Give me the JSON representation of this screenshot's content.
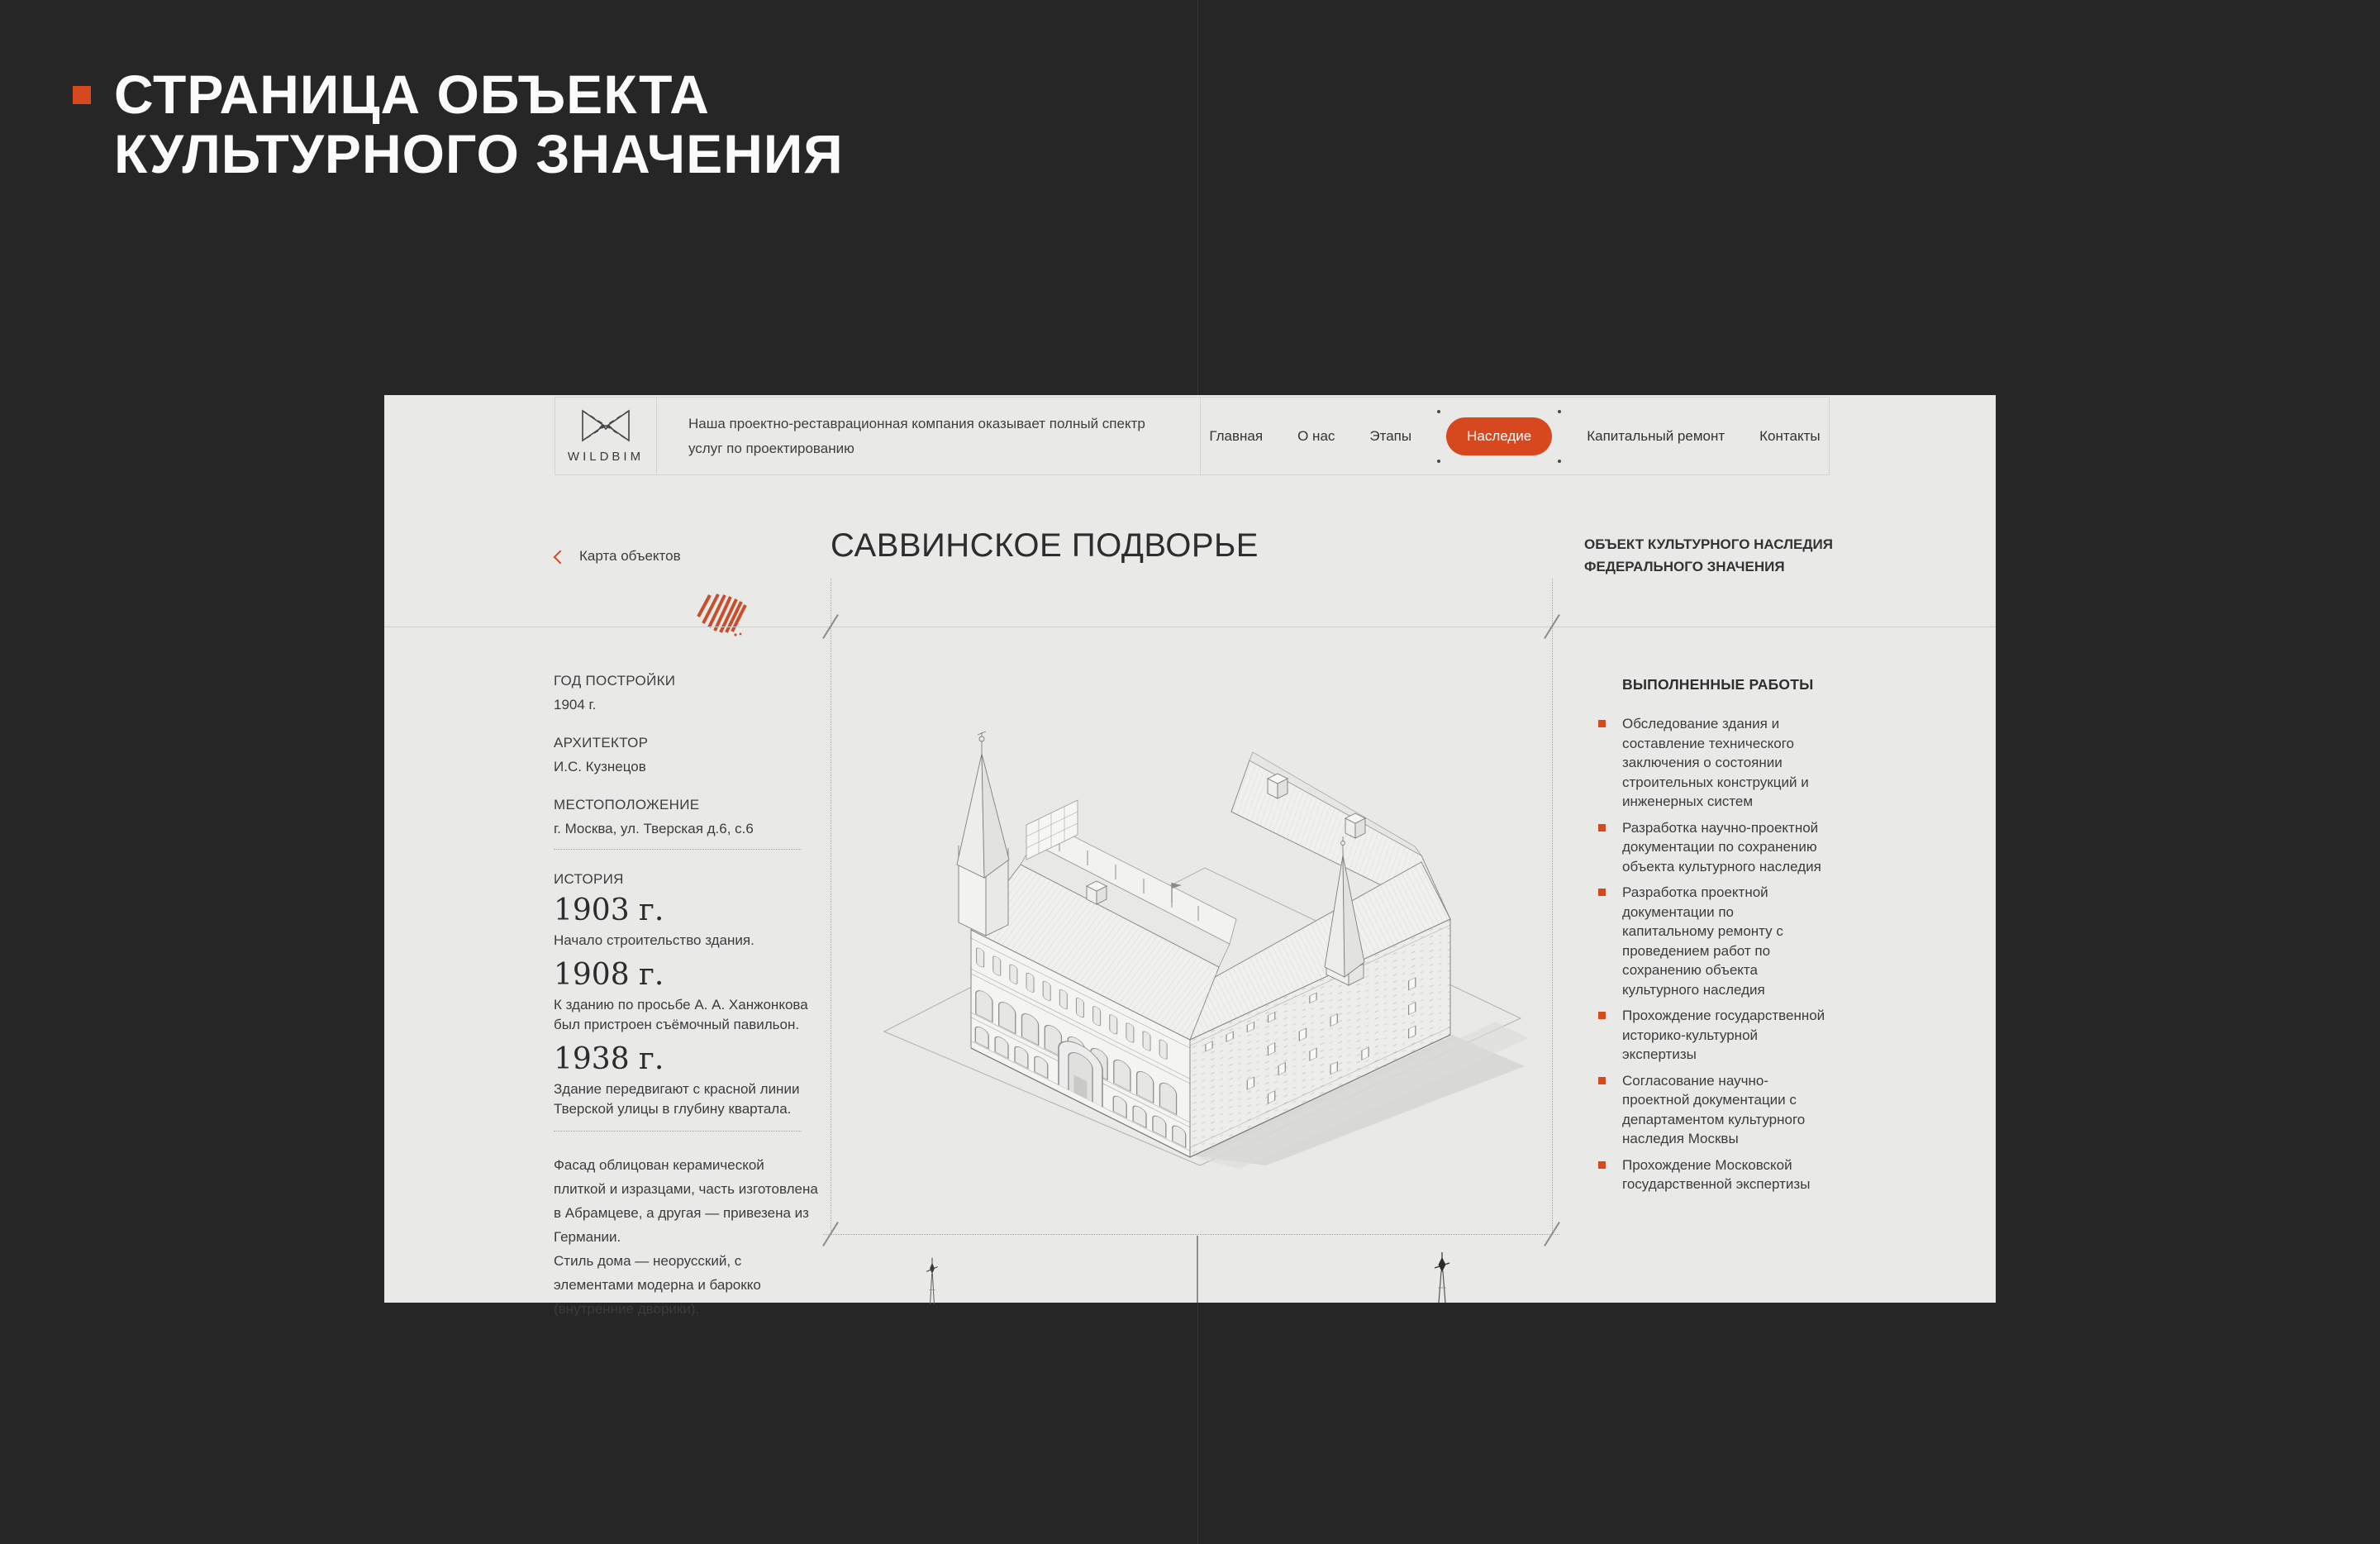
{
  "colors": {
    "accent": "#d8481e",
    "dark_bg": "#262627",
    "page_bg": "#e9e9e8"
  },
  "slide": {
    "title": "СТРАНИЦА ОБЪЕКТА\nКУЛЬТУРНОГО ЗНАЧЕНИЯ"
  },
  "header": {
    "logo": "WILDBIM",
    "tagline": "Наша проектно-реставрационная компания оказывает полный спектр\nуслуг по проектированию",
    "nav": [
      "Главная",
      "О нас",
      "Этапы",
      "Наследие",
      "Капитальный ремонт",
      "Контакты"
    ],
    "active_nav": "Наследие"
  },
  "page": {
    "back_link": "Карта объектов",
    "title": "САВВИНСКОЕ ПОДВОРЬЕ",
    "heritage_badge": "ОБЪЕКТ КУЛЬТУРНОГО НАСЛЕДИЯ\nФЕДЕРАЛЬНОГО ЗНАЧЕНИЯ"
  },
  "details": [
    {
      "label": "ГОД ПОСТРОЙКИ",
      "value": "1904 г."
    },
    {
      "label": "АРХИТЕКТОР",
      "value": "И.С. Кузнецов"
    },
    {
      "label": "МЕСТОПОЛОЖЕНИЕ",
      "value": "г. Москва, ул. Тверская д.6, с.6"
    }
  ],
  "history": {
    "label": "ИСТОРИЯ",
    "events": [
      {
        "year": "1903 г.",
        "text": "Начало строительство здания."
      },
      {
        "year": "1908 г.",
        "text": "К зданию по просьбе А. А. Ханжонкова был пристроен съёмочный павильон."
      },
      {
        "year": "1938 г.",
        "text": "Здание передвигают с красной линии Тверской улицы в глубину квартала."
      }
    ],
    "note": "Фасад облицован керамической плиткой и изразцами, часть изготовлена в Абрамцеве, а другая — привезена из Германии.\nСтиль дома — неорусский, с элементами модерна и барокко (внутренние дворики)."
  },
  "works": {
    "title": "ВЫПОЛНЕННЫЕ РАБОТЫ",
    "items": [
      "Обследование здания и составление технического заключения о состоянии строительных конструкций и инженерных систем",
      "Разработка научно-проектной документации по сохранению объекта культурного наследия",
      "Разработка проектной документации по капитальному ремонту с проведением работ по сохранению объекта культурного наследия",
      "Прохождение государственной историко-культурной экспертизы",
      "Согласование научно-проектной документации с департаментом культурного наследия Москвы",
      "Прохождение Московской государственной экспертизы"
    ]
  }
}
